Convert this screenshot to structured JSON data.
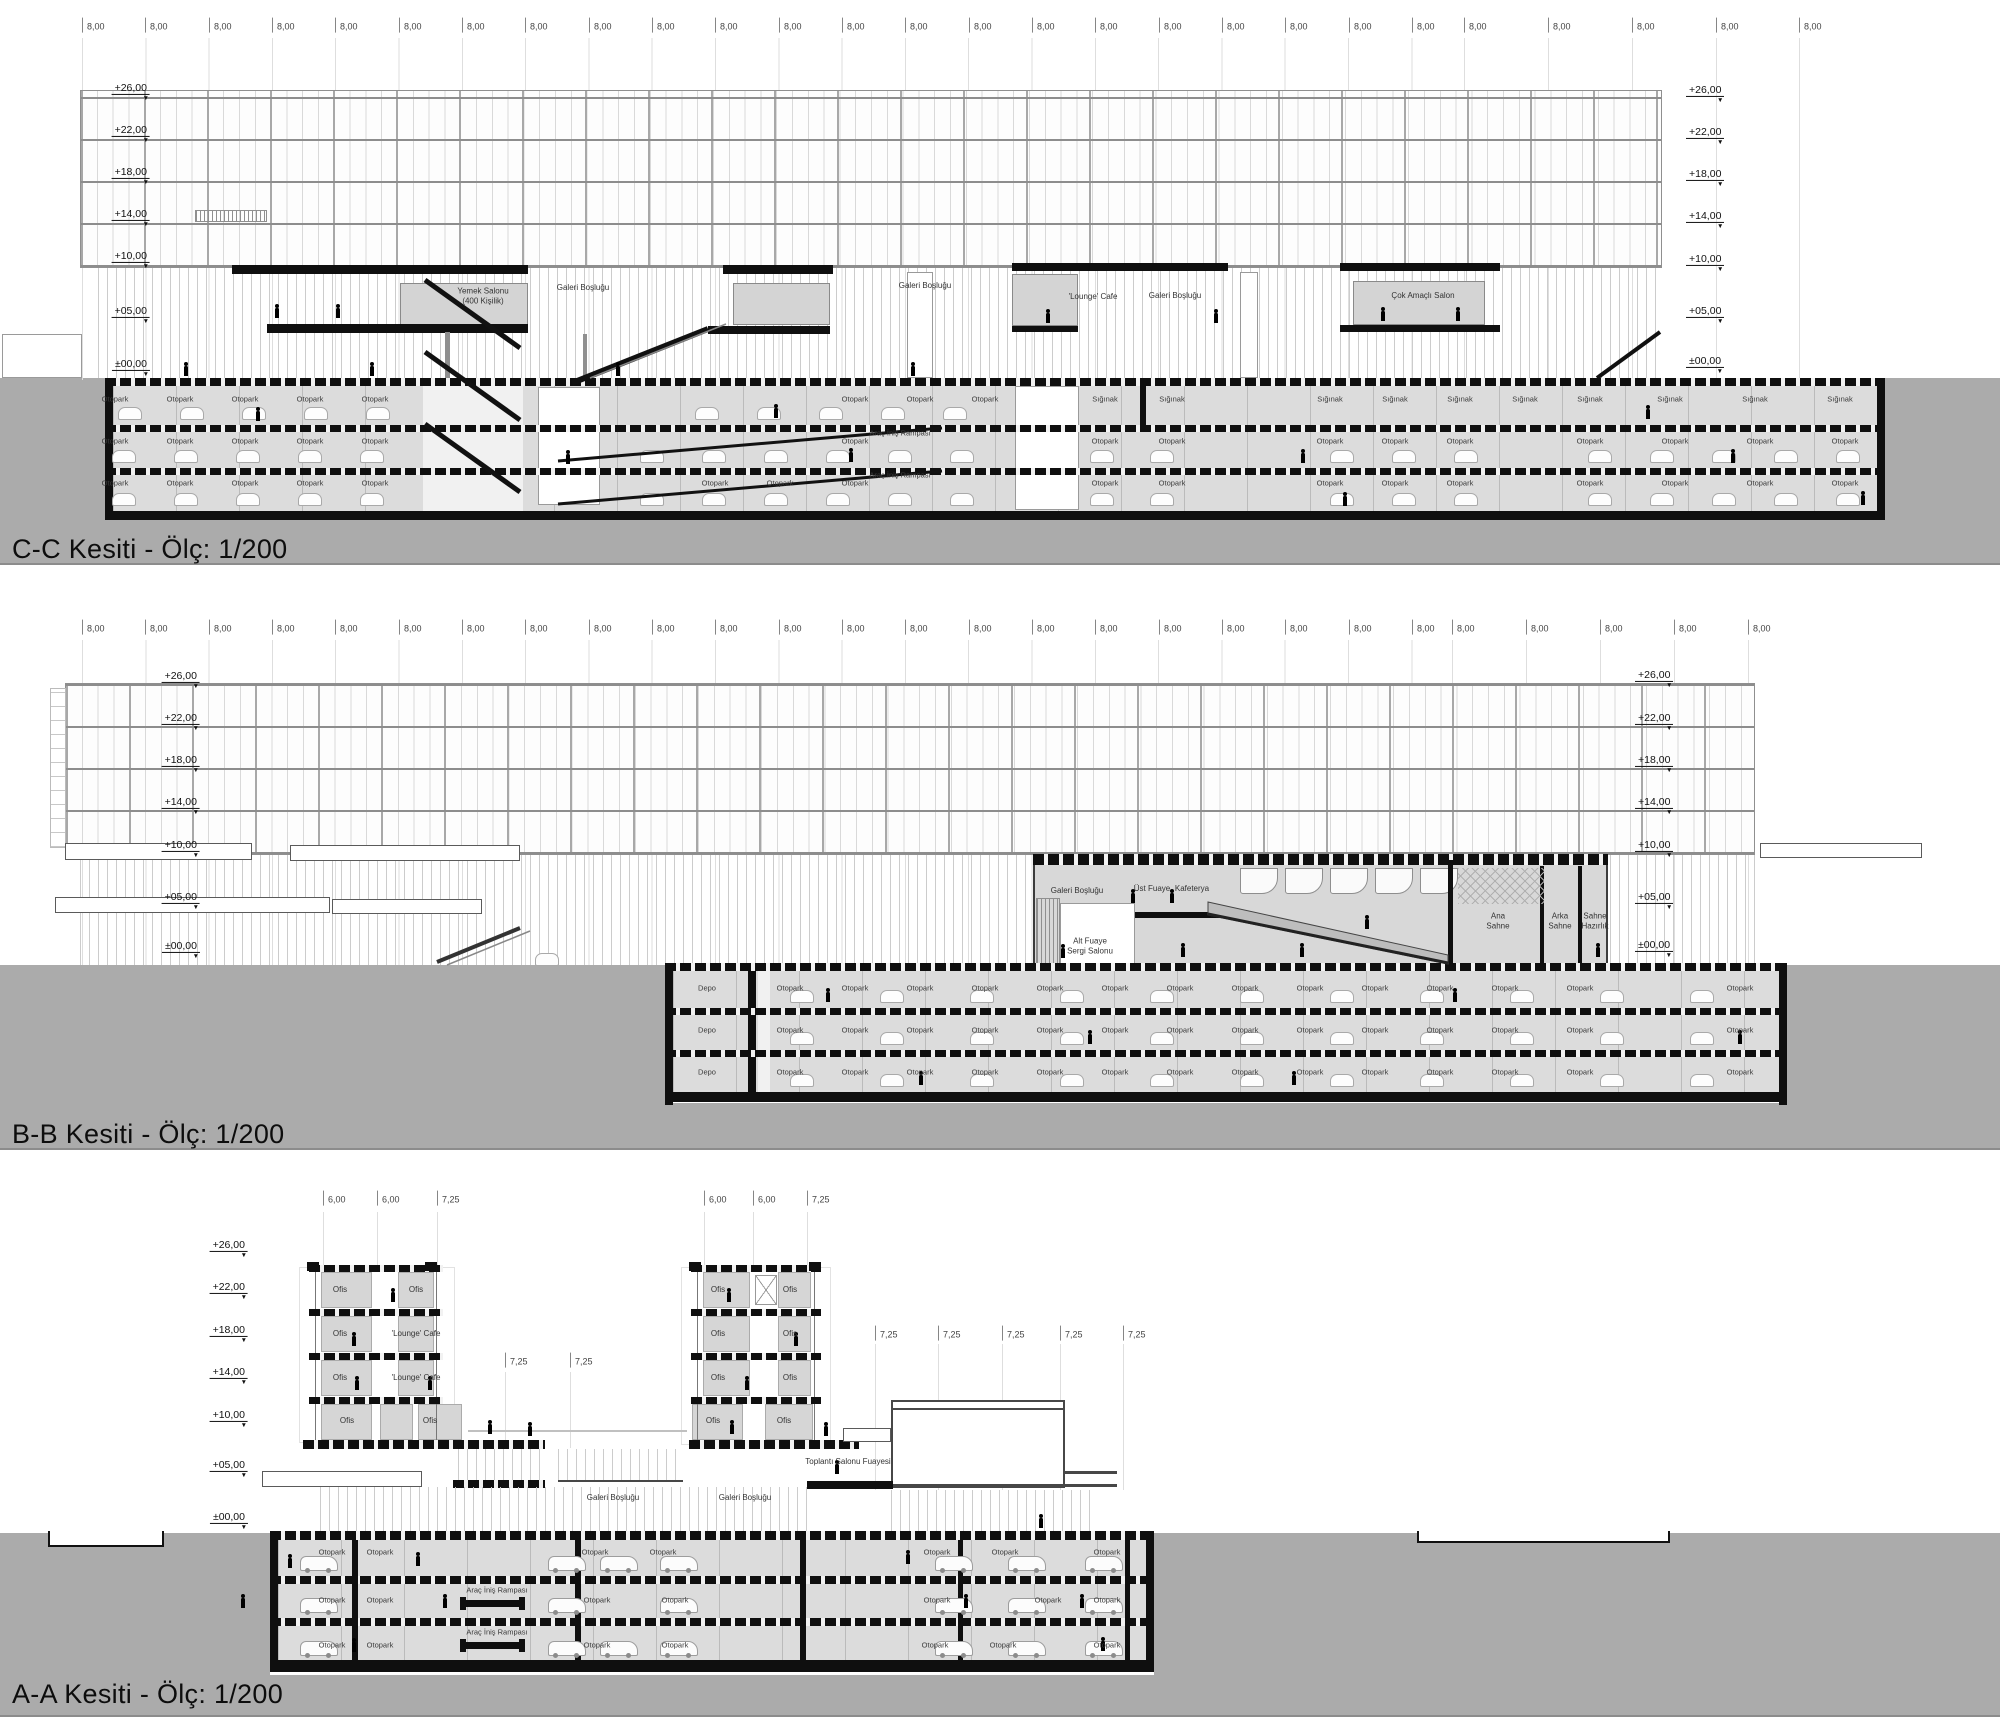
{
  "sections": [
    {
      "id": "cc",
      "title": "C-C Kesiti - Ölç: 1/200",
      "dim_rows": [
        {
          "label": "8,00",
          "y": 27,
          "xs": [
            82,
            145,
            209,
            272,
            335,
            399,
            462,
            525,
            589,
            652,
            715,
            779,
            842,
            905,
            969,
            1032,
            1095,
            1159,
            1222,
            1285,
            1349,
            1412,
            1464,
            1548,
            1632,
            1716,
            1799
          ]
        }
      ],
      "elev_left": {
        "anchor_x": 150,
        "items": [
          {
            "t": "+26,00",
            "y": 95
          },
          {
            "t": "+22,00",
            "y": 137
          },
          {
            "t": "+18,00",
            "y": 179
          },
          {
            "t": "+14,00",
            "y": 221
          },
          {
            "t": "+10,00",
            "y": 263
          },
          {
            "t": "+05,00",
            "y": 318
          },
          {
            "t": "±00,00",
            "y": 371
          }
        ]
      },
      "elev_right": {
        "anchor_x": 1686,
        "items": [
          {
            "t": "+26,00",
            "y": 97
          },
          {
            "t": "+22,00",
            "y": 139
          },
          {
            "t": "+18,00",
            "y": 181
          },
          {
            "t": "+14,00",
            "y": 223
          },
          {
            "t": "+10,00",
            "y": 266
          },
          {
            "t": "+05,00",
            "y": 318
          },
          {
            "t": "±00,00",
            "y": 368
          }
        ]
      },
      "rooms": [
        {
          "t": "Yemek Salonu\n(400 Kişilik)",
          "x": 483,
          "y": 296
        },
        {
          "t": "Galeri Boşluğu",
          "x": 583,
          "y": 288
        },
        {
          "t": "Galeri Boşluğu",
          "x": 925,
          "y": 286
        },
        {
          "t": "'Lounge' Cafe",
          "x": 1093,
          "y": 297
        },
        {
          "t": "Galeri Boşluğu",
          "x": 1175,
          "y": 296
        },
        {
          "t": "Çok Amaçlı Salon",
          "x": 1423,
          "y": 296
        }
      ],
      "parking_rows": [
        {
          "label": "Otopark",
          "y": 399,
          "xs": [
            115,
            180,
            245,
            310,
            375,
            855,
            920,
            985
          ]
        },
        {
          "label": "Sığınak",
          "y": 399,
          "xs": [
            1105,
            1172,
            1330,
            1395,
            1460,
            1525,
            1590,
            1670,
            1755,
            1840
          ]
        },
        {
          "label": "Otopark",
          "y": 441,
          "xs": [
            115,
            180,
            245,
            310,
            375,
            855,
            1105,
            1172,
            1330,
            1395,
            1460,
            1590,
            1675,
            1760,
            1845
          ]
        },
        {
          "label": "Araç İniş Rampası",
          "y": 433,
          "xs": [
            900
          ]
        },
        {
          "label": "Otopark",
          "y": 483,
          "xs": [
            115,
            180,
            245,
            310,
            375,
            715,
            780,
            855,
            1105,
            1172,
            1330,
            1395,
            1460,
            1590,
            1675,
            1760,
            1845
          ]
        },
        {
          "label": "Araç İniş Rampası",
          "y": 475,
          "xs": [
            900
          ]
        }
      ]
    },
    {
      "id": "bb",
      "title": "B-B Kesiti - Ölç: 1/200",
      "dim_rows": [
        {
          "label": "8,00",
          "y": 629,
          "xs": [
            82,
            145,
            209,
            272,
            335,
            399,
            462,
            525,
            589,
            652,
            715,
            779,
            842,
            905,
            969,
            1032,
            1095,
            1159,
            1222,
            1285,
            1349,
            1412,
            1452,
            1526,
            1600,
            1674,
            1748
          ]
        }
      ],
      "elev_left": {
        "anchor_x": 200,
        "items": [
          {
            "t": "+26,00",
            "y": 683
          },
          {
            "t": "+22,00",
            "y": 725
          },
          {
            "t": "+18,00",
            "y": 767
          },
          {
            "t": "+14,00",
            "y": 809
          },
          {
            "t": "+10,00",
            "y": 852
          },
          {
            "t": "+05,00",
            "y": 904
          },
          {
            "t": "±00,00",
            "y": 953
          }
        ]
      },
      "elev_right": {
        "anchor_x": 1635,
        "items": [
          {
            "t": "+26,00",
            "y": 682
          },
          {
            "t": "+22,00",
            "y": 725
          },
          {
            "t": "+18,00",
            "y": 767
          },
          {
            "t": "+14,00",
            "y": 809
          },
          {
            "t": "+10,00",
            "y": 852
          },
          {
            "t": "+05,00",
            "y": 904
          },
          {
            "t": "±00,00",
            "y": 952
          }
        ]
      },
      "rooms": [
        {
          "t": "Galeri Boşluğu",
          "x": 1077,
          "y": 891
        },
        {
          "t": "Üst Fuaye",
          "x": 1152,
          "y": 889
        },
        {
          "t": "Kafeterya",
          "x": 1192,
          "y": 889
        },
        {
          "t": "Alt Fuaye\nSergi Salonu",
          "x": 1090,
          "y": 946
        },
        {
          "t": "Ana\nSahne",
          "x": 1498,
          "y": 921
        },
        {
          "t": "Arka\nSahne",
          "x": 1560,
          "y": 921
        },
        {
          "t": "Sahne\nHazırlık",
          "x": 1595,
          "y": 921
        }
      ],
      "parking_rows": [
        {
          "label": "Depo",
          "y": 988,
          "xs": [
            707
          ]
        },
        {
          "label": "Depo",
          "y": 1030,
          "xs": [
            707
          ]
        },
        {
          "label": "Depo",
          "y": 1072,
          "xs": [
            707
          ]
        },
        {
          "label": "Otopark",
          "y": 988,
          "xs": [
            790,
            855,
            920,
            985,
            1050,
            1115,
            1180,
            1245,
            1310,
            1375,
            1440,
            1505,
            1580,
            1740
          ]
        },
        {
          "label": "Otopark",
          "y": 1030,
          "xs": [
            790,
            855,
            920,
            985,
            1050,
            1115,
            1180,
            1245,
            1310,
            1375,
            1440,
            1505,
            1580,
            1740
          ]
        },
        {
          "label": "Otopark",
          "y": 1072,
          "xs": [
            790,
            855,
            920,
            985,
            1050,
            1115,
            1180,
            1245,
            1310,
            1375,
            1440,
            1505,
            1580,
            1740
          ]
        }
      ]
    },
    {
      "id": "aa",
      "title": "A-A Kesiti - Ölç: 1/200",
      "dim_rows": [
        {
          "label": "6,00",
          "y": 1200,
          "xs": [
            323,
            377,
            704,
            753
          ]
        },
        {
          "label": "7,25",
          "y": 1200,
          "xs": [
            437,
            807
          ]
        },
        {
          "label": "7,25",
          "y": 1362,
          "xs": [
            505,
            570
          ]
        },
        {
          "label": "7,25",
          "y": 1335,
          "xs": [
            875,
            938,
            1002,
            1060,
            1123
          ]
        }
      ],
      "elev_left": {
        "anchor_x": 248,
        "items": [
          {
            "t": "+26,00",
            "y": 1252
          },
          {
            "t": "+22,00",
            "y": 1294
          },
          {
            "t": "+18,00",
            "y": 1337
          },
          {
            "t": "+14,00",
            "y": 1379
          },
          {
            "t": "+10,00",
            "y": 1422
          },
          {
            "t": "+05,00",
            "y": 1472
          },
          {
            "t": "±00,00",
            "y": 1524
          }
        ]
      },
      "elev_right": {
        "anchor_x": 0,
        "items": []
      },
      "rooms": [
        {
          "t": "Ofis",
          "x": 340,
          "y": 1290
        },
        {
          "t": "Ofis",
          "x": 416,
          "y": 1290
        },
        {
          "t": "Ofis",
          "x": 340,
          "y": 1334
        },
        {
          "t": "'Lounge' Cafe",
          "x": 416,
          "y": 1334
        },
        {
          "t": "Ofis",
          "x": 340,
          "y": 1378
        },
        {
          "t": "'Lounge' Cafe",
          "x": 416,
          "y": 1378
        },
        {
          "t": "Ofis",
          "x": 347,
          "y": 1421
        },
        {
          "t": "Ofis",
          "x": 430,
          "y": 1421
        },
        {
          "t": "Ofis",
          "x": 718,
          "y": 1290
        },
        {
          "t": "Ofis",
          "x": 790,
          "y": 1290
        },
        {
          "t": "Ofis",
          "x": 718,
          "y": 1334
        },
        {
          "t": "Ofis",
          "x": 790,
          "y": 1334
        },
        {
          "t": "Ofis",
          "x": 718,
          "y": 1378
        },
        {
          "t": "Ofis",
          "x": 790,
          "y": 1378
        },
        {
          "t": "Ofis",
          "x": 713,
          "y": 1421
        },
        {
          "t": "Ofis",
          "x": 784,
          "y": 1421
        },
        {
          "t": "Toplantı Salonu Fuayesi",
          "x": 848,
          "y": 1462
        },
        {
          "t": "Galeri Boşluğu",
          "x": 613,
          "y": 1498
        },
        {
          "t": "Galeri Boşluğu",
          "x": 745,
          "y": 1498
        }
      ],
      "parking_rows": [
        {
          "label": "Otopark",
          "y": 1552,
          "xs": [
            332,
            380,
            595,
            663,
            937,
            1005,
            1107
          ]
        },
        {
          "label": "Otopark",
          "y": 1600,
          "xs": [
            332,
            380,
            597,
            675,
            937,
            1048,
            1107
          ]
        },
        {
          "label": "Araç İniş Rampası",
          "y": 1590,
          "xs": [
            497
          ]
        },
        {
          "label": "Otopark",
          "y": 1645,
          "xs": [
            332,
            380,
            597,
            675,
            935,
            1003,
            1107
          ]
        },
        {
          "label": "Araç İniş Rampası",
          "y": 1632,
          "xs": [
            497
          ]
        }
      ]
    }
  ]
}
